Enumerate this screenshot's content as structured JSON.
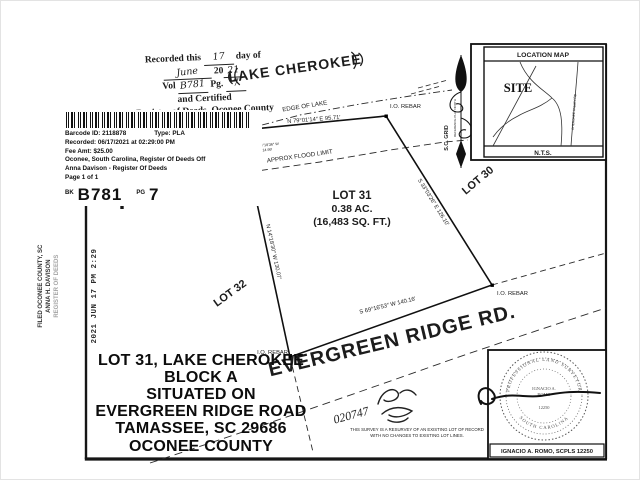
{
  "recording_stamp": {
    "line1_pre": "Recorded this",
    "line1_value": "17",
    "line1_post": "day of",
    "line2_value": "June",
    "line2_year_pre": "20",
    "line2_year": "21",
    "line3_vol_label": "Vol",
    "line3_vol": "B781",
    "line3_pg_label": "Pg.",
    "line3_pg": "7",
    "line4": "and Certified",
    "line5": "Register of Deeds, Oconee County"
  },
  "barcode_box": {
    "row1_left": "Barcode ID: 2118878",
    "row1_right": "Type: PLA",
    "rows": [
      "Recorded: 06/17/2021 at 02:29:00 PM",
      "Fee Amt: $25.00",
      "Oconee, South Carolina, Register Of Deeds Off",
      "Anna Davison - Register Of Deeds",
      "Page 1 of 1"
    ],
    "bk_label": "BK",
    "bk_value": "B781",
    "pg_label": "PG",
    "pg_value": "7"
  },
  "filed_stamp": {
    "lines": [
      "FILED OCONEE COUNTY, SC",
      "ANNA H. DAVISON",
      "REGISTER OF DEEDS"
    ]
  },
  "date_stamp": "2021 JUN 17 PM 2:29",
  "title_block": {
    "lines": [
      "LOT 31, LAKE CHEROKEE",
      "BLOCK  A",
      "SITUATED ON",
      "EVERGREEN RIDGE ROAD",
      "TAMASSEE, SC 29686",
      "OCONEE COUNTY"
    ]
  },
  "plat": {
    "lake_label": "LAKE CHEROKEE",
    "edge_of_lake": "EDGE OF LAKE",
    "flood_limit": "APPROX FLOOD LIMIT",
    "lot31_name": "LOT 31",
    "lot31_area_ac": "0.38 AC.",
    "lot31_area_sf": "(16,483 SQ. FT.)",
    "lot30": "LOT 30",
    "lot32": "LOT 32",
    "road": "EVERGREEN RIDGE RD.",
    "bearing_north": "N 79°01'14″ E   95.71′",
    "bearing_east": "S 33°03'26″ E   126.10′",
    "bearing_south": "S 69°16'53″ W   140.16′",
    "bearing_west": "N 14°18'30″ W   130.07′",
    "bearing_jog_1": "S 14°18'36″ W",
    "bearing_jog_2": "14.99′",
    "rebar": "I.O. REBAR",
    "pp": "PP",
    "handwritten_number": "020747"
  },
  "location_map": {
    "title": "LOCATION MAP",
    "site": "SITE",
    "scale": "N.T.S.",
    "road_label": "CHEROKEE VALLEY RD"
  },
  "north_arrow": {
    "label_grid": "S.C. GRID",
    "label_ref": "REFERENCE PLAT NORTH"
  },
  "seal": {
    "arc_top": "PROFESSIONAL LAND SURVEYOR",
    "arc_bottom": "SOUTH CAROLINA",
    "center_1": "IGNACIO A.",
    "center_2": "ROMO",
    "center_3": "12250",
    "name_plate": "IGNACIO A. ROMO, SCPLS 12250"
  },
  "survey_note": {
    "line1": "THIS SURVEY IS A RESURVEY OF AN EXISTING LOT OF RECORD",
    "line2": "WITH NO CHANGES TO EXISTING LOT LINES."
  }
}
